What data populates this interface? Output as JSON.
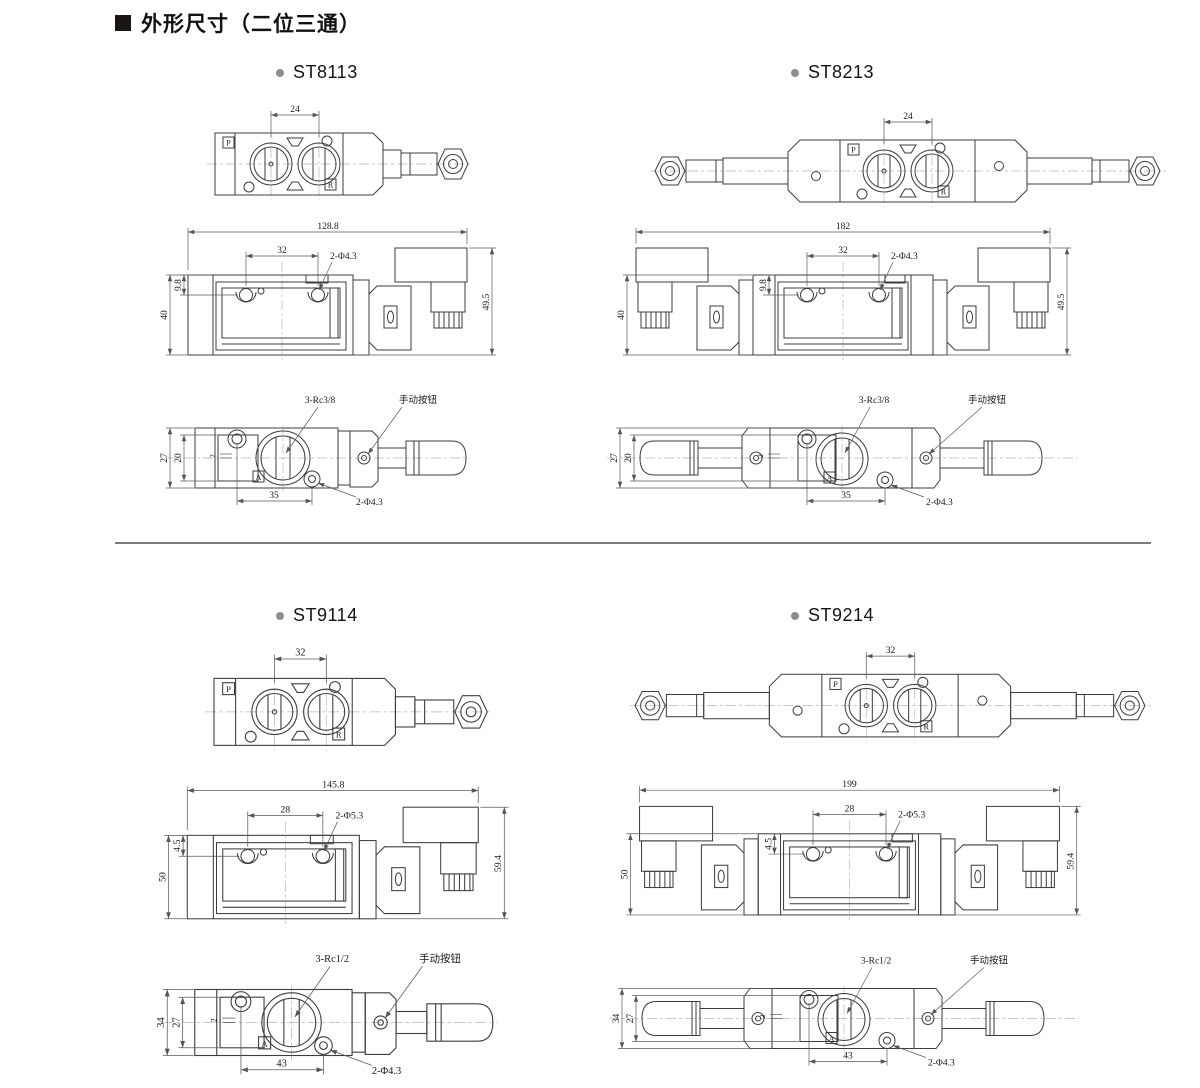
{
  "page": {
    "title": "外形尺寸（二位三通）"
  },
  "ports": {
    "p": "P",
    "r": "R",
    "a": "A"
  },
  "models": [
    {
      "label": "ST8113",
      "solenoid": "single",
      "top": {
        "spacing": "24"
      },
      "front": {
        "overall": "128.8",
        "spacing": "32",
        "holes": "2-Φ4.3",
        "offset": "9.8",
        "height": "40",
        "total_height": "49.5"
      },
      "side": {
        "threads": "3-Rc3/8",
        "manual": "手动按钮",
        "height": "27",
        "inner": "20",
        "offset": "2",
        "spacing": "35",
        "holes": "2-Φ4.3"
      }
    },
    {
      "label": "ST8213",
      "solenoid": "double",
      "top": {
        "spacing": "24"
      },
      "front": {
        "overall": "182",
        "spacing": "32",
        "holes": "2-Φ4.3",
        "offset": "9.8",
        "height": "40",
        "total_height": "49.5"
      },
      "side": {
        "threads": "3-Rc3/8",
        "manual": "手动按钮",
        "height": "27",
        "inner": "20",
        "offset": "2",
        "spacing": "35",
        "holes": "2-Φ4.3"
      }
    },
    {
      "label": "ST9114",
      "solenoid": "single",
      "top": {
        "spacing": "32"
      },
      "front": {
        "overall": "145.8",
        "spacing": "28",
        "holes": "2-Φ5.3",
        "offset": "4.5",
        "height": "50",
        "total_height": "59.4"
      },
      "side": {
        "threads": "3-Rc1/2",
        "manual": "手动按钮",
        "height": "34",
        "inner": "27",
        "offset": "2",
        "spacing": "43",
        "holes": "2-Φ4.3"
      }
    },
    {
      "label": "ST9214",
      "solenoid": "double",
      "top": {
        "spacing": "32"
      },
      "front": {
        "overall": "199",
        "spacing": "28",
        "holes": "2-Φ5.3",
        "offset": "4.5",
        "height": "50",
        "total_height": "59.4"
      },
      "side": {
        "threads": "3-Rc1/2",
        "manual": "手动按钮",
        "height": "34",
        "inner": "27",
        "offset": "2",
        "spacing": "43",
        "holes": "2-Φ4.3"
      }
    }
  ]
}
